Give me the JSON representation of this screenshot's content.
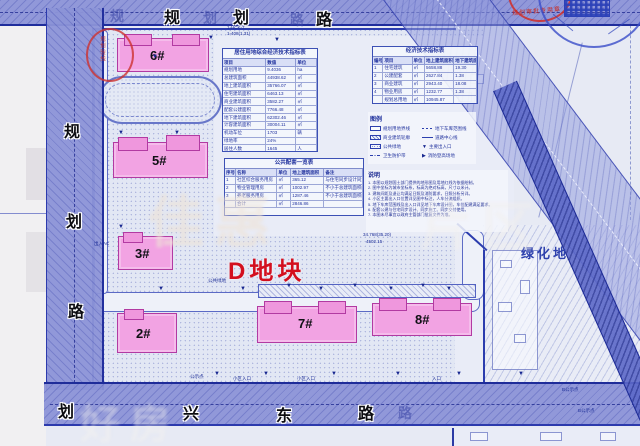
{
  "plot_label": "D地块",
  "green_label": "绿化地",
  "roads": {
    "top": {
      "name": "规划路",
      "bold": [
        "规",
        "划",
        "路"
      ],
      "ghost": [
        "规",
        "划",
        "路"
      ]
    },
    "left": {
      "name": "规划路",
      "bold": [
        "规",
        "划",
        "路",
        "划"
      ]
    },
    "bottom": {
      "name": "兴东路",
      "bold": [
        "兴",
        "东",
        "路"
      ],
      "ghost": [
        "路"
      ]
    }
  },
  "buildings": [
    {
      "id": "6#"
    },
    {
      "id": "5#"
    },
    {
      "id": "3#"
    },
    {
      "id": "2#"
    },
    {
      "id": "7#"
    },
    {
      "id": "8#"
    }
  ],
  "tables": {
    "main": {
      "title": "居住用地综合经济技术指标表",
      "widths": [
        46,
        32,
        22
      ],
      "header": [
        "项目",
        "数值",
        "单位"
      ],
      "rows": [
        [
          "规划用地",
          "9.4036",
          "ha"
        ],
        [
          "总建筑面积",
          "44938.62",
          "㎡"
        ],
        [
          "地上建筑面积",
          "35766.07",
          "㎡"
        ],
        [
          "住宅建筑面积",
          "6463.13",
          "㎡"
        ],
        [
          "商业建筑面积",
          "3582.27",
          "㎡"
        ],
        [
          "配套公建面积",
          "7766.48",
          "㎡"
        ],
        [
          "地下建筑面积",
          "62302.46",
          "㎡"
        ],
        [
          "计容建筑面积",
          "30004.11",
          "㎡"
        ],
        [
          "机动车位",
          "1703",
          "辆"
        ],
        [
          "绿地率",
          "24%",
          ""
        ],
        [
          "居住人数",
          "1645",
          "人"
        ]
      ]
    },
    "compare": {
      "title": "经济技术指标表",
      "widths": [
        10,
        28,
        12,
        28,
        22
      ],
      "header": [
        "编号",
        "项目",
        "单位",
        "地上建筑面积",
        "地下建筑面积"
      ],
      "rows": [
        [
          "1",
          "住宅建筑",
          "㎡",
          "5658.88",
          "19.30"
        ],
        [
          "2",
          "公建配套",
          "㎡",
          "2627.84",
          "1.38"
        ],
        [
          "3",
          "商业建筑",
          "㎡",
          "2943.40",
          "18.08"
        ],
        [
          "4",
          "物业用房",
          "㎡",
          "1232.77",
          "1.38"
        ],
        [
          "",
          "规划总用地",
          "㎡",
          "10945.87",
          ""
        ]
      ]
    },
    "public": {
      "title": "公共配套一览表",
      "widths": [
        8,
        30,
        10,
        24,
        28
      ],
      "header": [
        "序号",
        "名称",
        "单位",
        "地上建筑面积",
        "备注"
      ],
      "rows": [
        [
          "1",
          "社区综合服务用房",
          "㎡",
          "365.12",
          "与住宅同步设计同步验收交付"
        ],
        [
          "2",
          "物业管理用房",
          "㎡",
          "1002.97",
          "不小于总建筑面积的2‰"
        ],
        [
          "3",
          "养老服务用房",
          "㎡",
          "1287.46",
          "不小于总建筑面积的2‰"
        ],
        [
          "",
          "合计",
          "㎡",
          "2846.86",
          ""
        ]
      ]
    }
  },
  "legend": {
    "title": "图例",
    "items": [
      {
        "sym": "rect",
        "label": "规划用地界线"
      },
      {
        "sym": "dashed",
        "label": "地下车库范围线"
      },
      {
        "sym": "hatch",
        "label": "商业建筑轮廓"
      },
      {
        "sym": "center",
        "label": "道路中心线"
      },
      {
        "sym": "dots",
        "label": "公共绿地"
      },
      {
        "sym": "flag",
        "label": "主要出入口"
      },
      {
        "sym": "dashdot",
        "label": "卫生防护带"
      },
      {
        "sym": "arrow",
        "label": "消防登高场地"
      }
    ]
  },
  "notes": {
    "title": "说明",
    "lines": [
      "1. 本图以规划国土部门提供的地形图及用地红线为依据绘制。",
      "2. 图中坐标为城市坐标系，标高为绝对标高，尺寸以米计。",
      "3. 建筑间距及退让均满足日照及消防要求，日照分析另详。",
      "4. 小区主要出入口位置详见图中标注，人车分流组织。",
      "5. 地下车库范围线及出入口详见地下车库设计图，车位配建满足要求。",
      "6. 配套公建与住宅同步设计、同步施工、同步交付使用。",
      "7. 本图未尽事宜以政府主管部门批复文件为准。"
    ]
  },
  "stamps": {
    "red_text": "规划审批专用章",
    "arc_text": "规划验线"
  },
  "annotations": [
    {
      "t": "1-HCK-7",
      "x": 227,
      "y": 25
    },
    {
      "t": "1-408(1.31)",
      "x": 227,
      "y": 31
    },
    {
      "t": "出入AC",
      "x": 94,
      "y": 241
    },
    {
      "t": "公共绿地",
      "x": 208,
      "y": 278
    },
    {
      "t": "34.768(35.20)",
      "x": 363,
      "y": 232
    },
    {
      "t": "4502.15",
      "x": 366,
      "y": 239
    },
    {
      "t": "公示点",
      "x": 190,
      "y": 374
    },
    {
      "t": "小区入口",
      "x": 233,
      "y": 376
    },
    {
      "t": "小区入口",
      "x": 297,
      "y": 376
    },
    {
      "t": "入口",
      "x": 432,
      "y": 376
    },
    {
      "t": "B公示点",
      "x": 562,
      "y": 387
    },
    {
      "t": "B公示点",
      "x": 578,
      "y": 408
    }
  ],
  "markers": [
    [
      152,
      54
    ],
    [
      208,
      35
    ],
    [
      274,
      37
    ],
    [
      118,
      130
    ],
    [
      174,
      130
    ],
    [
      118,
      224
    ],
    [
      158,
      286
    ],
    [
      240,
      286
    ],
    [
      318,
      286
    ],
    [
      388,
      286
    ],
    [
      446,
      286
    ],
    [
      214,
      371
    ],
    [
      263,
      371
    ],
    [
      331,
      371
    ],
    [
      395,
      371
    ],
    [
      456,
      371
    ],
    [
      518,
      371
    ],
    [
      286,
      283
    ],
    [
      352,
      283
    ],
    [
      420,
      283
    ]
  ],
  "watermarks": [
    {
      "t": "佳惠",
      "x": 148,
      "y": 178,
      "size": 56,
      "color": "rgba(238,226,214,0.6)"
    },
    {
      "t": "片区",
      "x": 420,
      "y": 185,
      "size": 52,
      "color": "rgba(242,240,238,0.5)"
    },
    {
      "t": "好房",
      "x": 80,
      "y": 392,
      "size": 40,
      "color": "rgba(245,242,238,0.42)"
    }
  ]
}
